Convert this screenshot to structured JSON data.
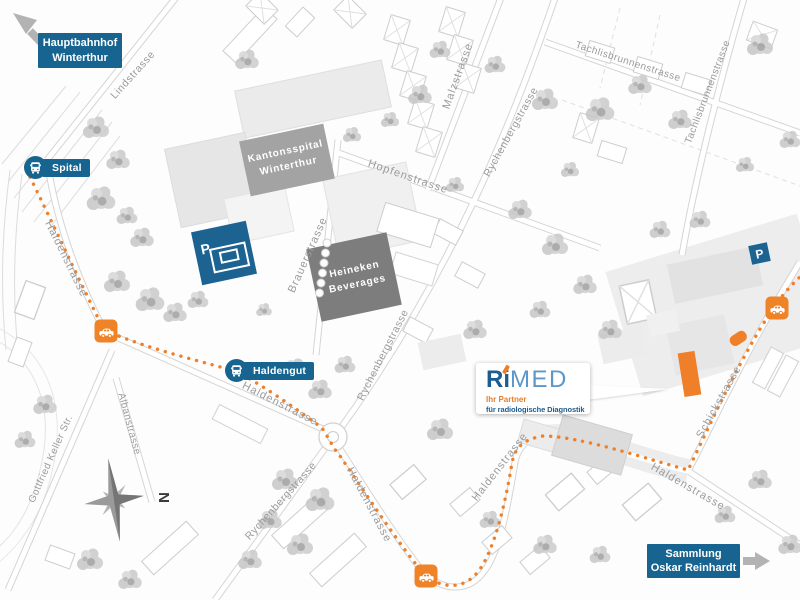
{
  "destinations": {
    "hauptbahnhof_line1": "Hauptbahnhof",
    "hauptbahnhof_line2": "Winterthur",
    "sammlung_line1": "Sammlung",
    "sammlung_line2": "Oskar Reinhardt"
  },
  "bus_stops": {
    "spital": "Spital",
    "haldengut": "Haldengut"
  },
  "buildings": {
    "kantonsspital_line1": "Kantonsspital",
    "kantonsspital_line2": "Winterthur",
    "heineken_line1": "Heineken",
    "heineken_line2": "Beverages"
  },
  "streets": {
    "lindstrasse": "Lindstrasse",
    "haldenstrasse": "Haldenstrasse",
    "brauerstrasse": "Brauerstrasse",
    "hopfenstrasse": "Hopfenstrasse",
    "malzstrasse": "Malzstrasse",
    "rychenbergstrasse": "Rychenbergstrasse",
    "tachlisbrunnenstrasse": "Tachlisbrunnenstrasse",
    "schickstrasse": "Schickstrasse",
    "gottfried_keller_str": "Gottfried Keller Str.",
    "albanstrasse": "Albanstrasse"
  },
  "logo": {
    "part_r": "R",
    "part_i": "i",
    "part_med": "MED",
    "tagline_line1": "Ihr Partner",
    "tagline_line2": "für radiologische Diagnostik"
  },
  "markers": {
    "parking": "P",
    "compass_north": "N"
  },
  "colors": {
    "brand_blue": "#16648F",
    "accent_orange": "#EF7F28",
    "building_dark_gray": "#7E7E7E",
    "street_label_gray": "#9B9B9B"
  }
}
